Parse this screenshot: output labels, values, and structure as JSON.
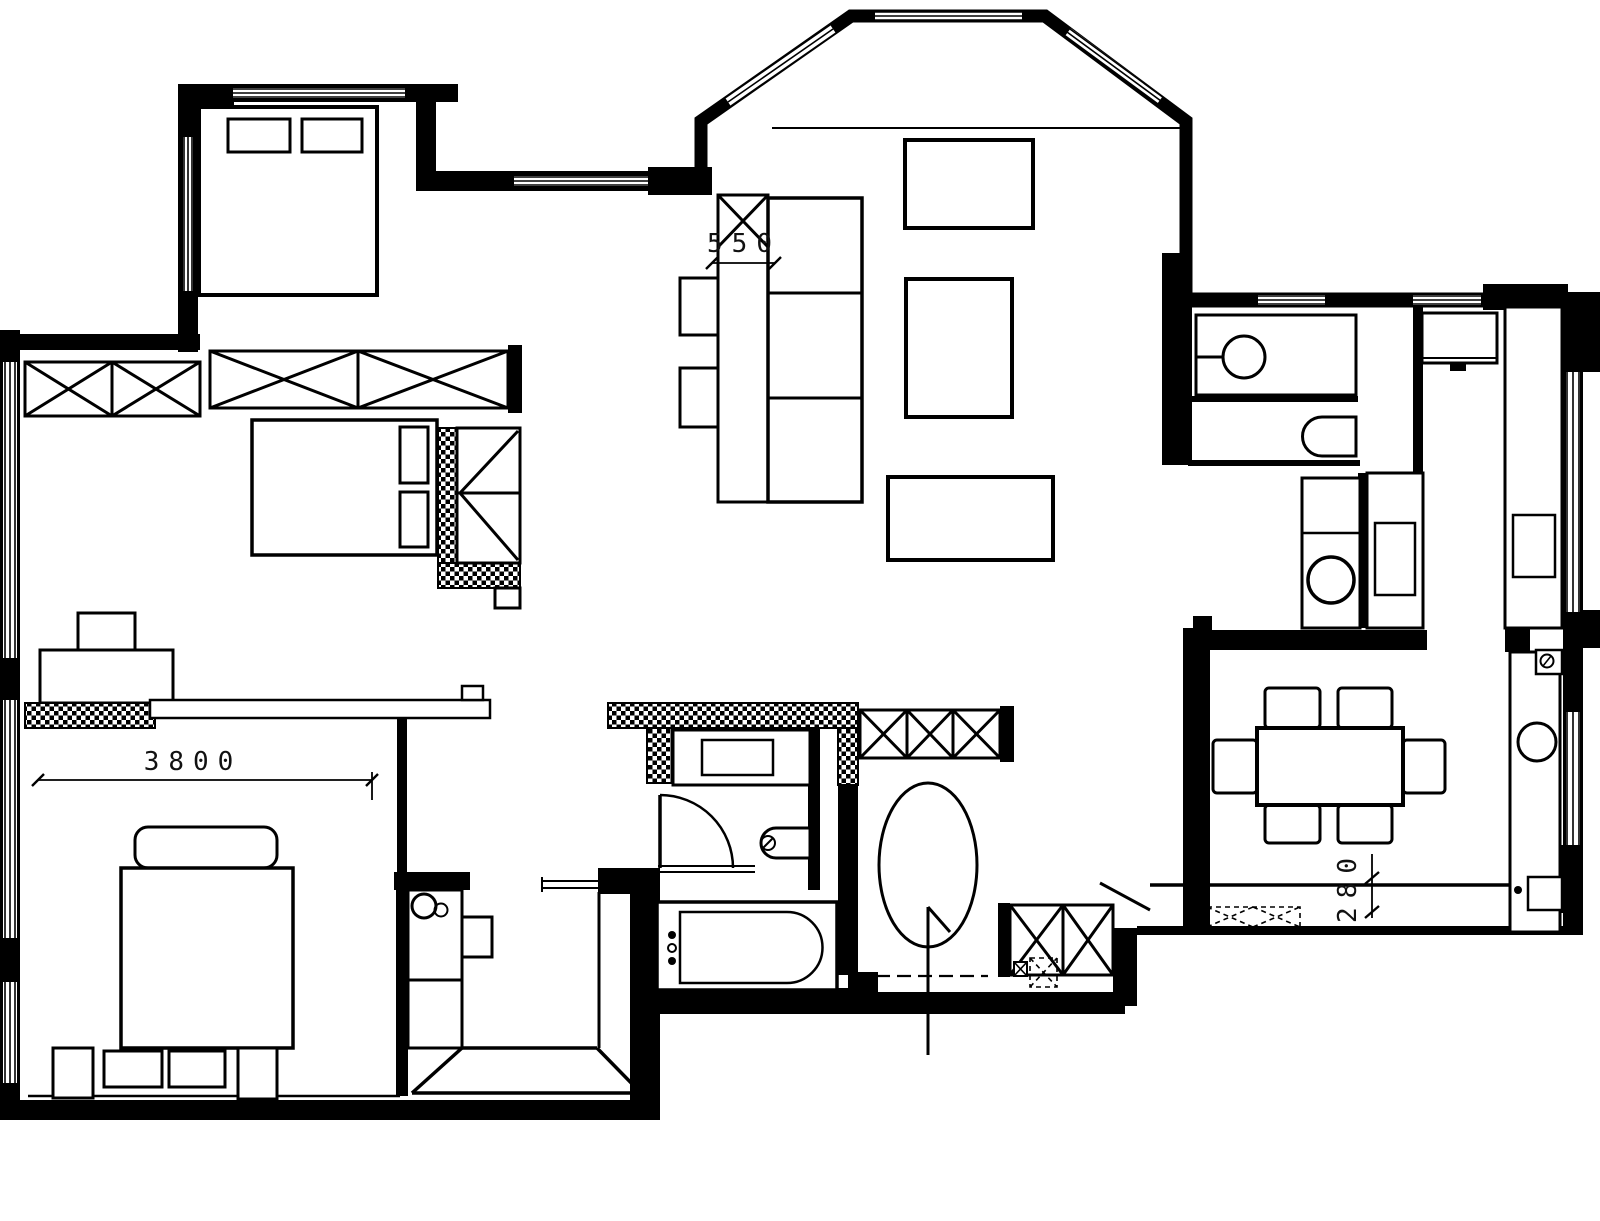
{
  "canvas": {
    "background": "#ffffff",
    "line_color": "#000000",
    "text_color": "#111111"
  },
  "dimension_labels": {
    "sofa_clearance": "550",
    "master_bedroom_width": "3800",
    "dining_wall_offset": "280"
  }
}
